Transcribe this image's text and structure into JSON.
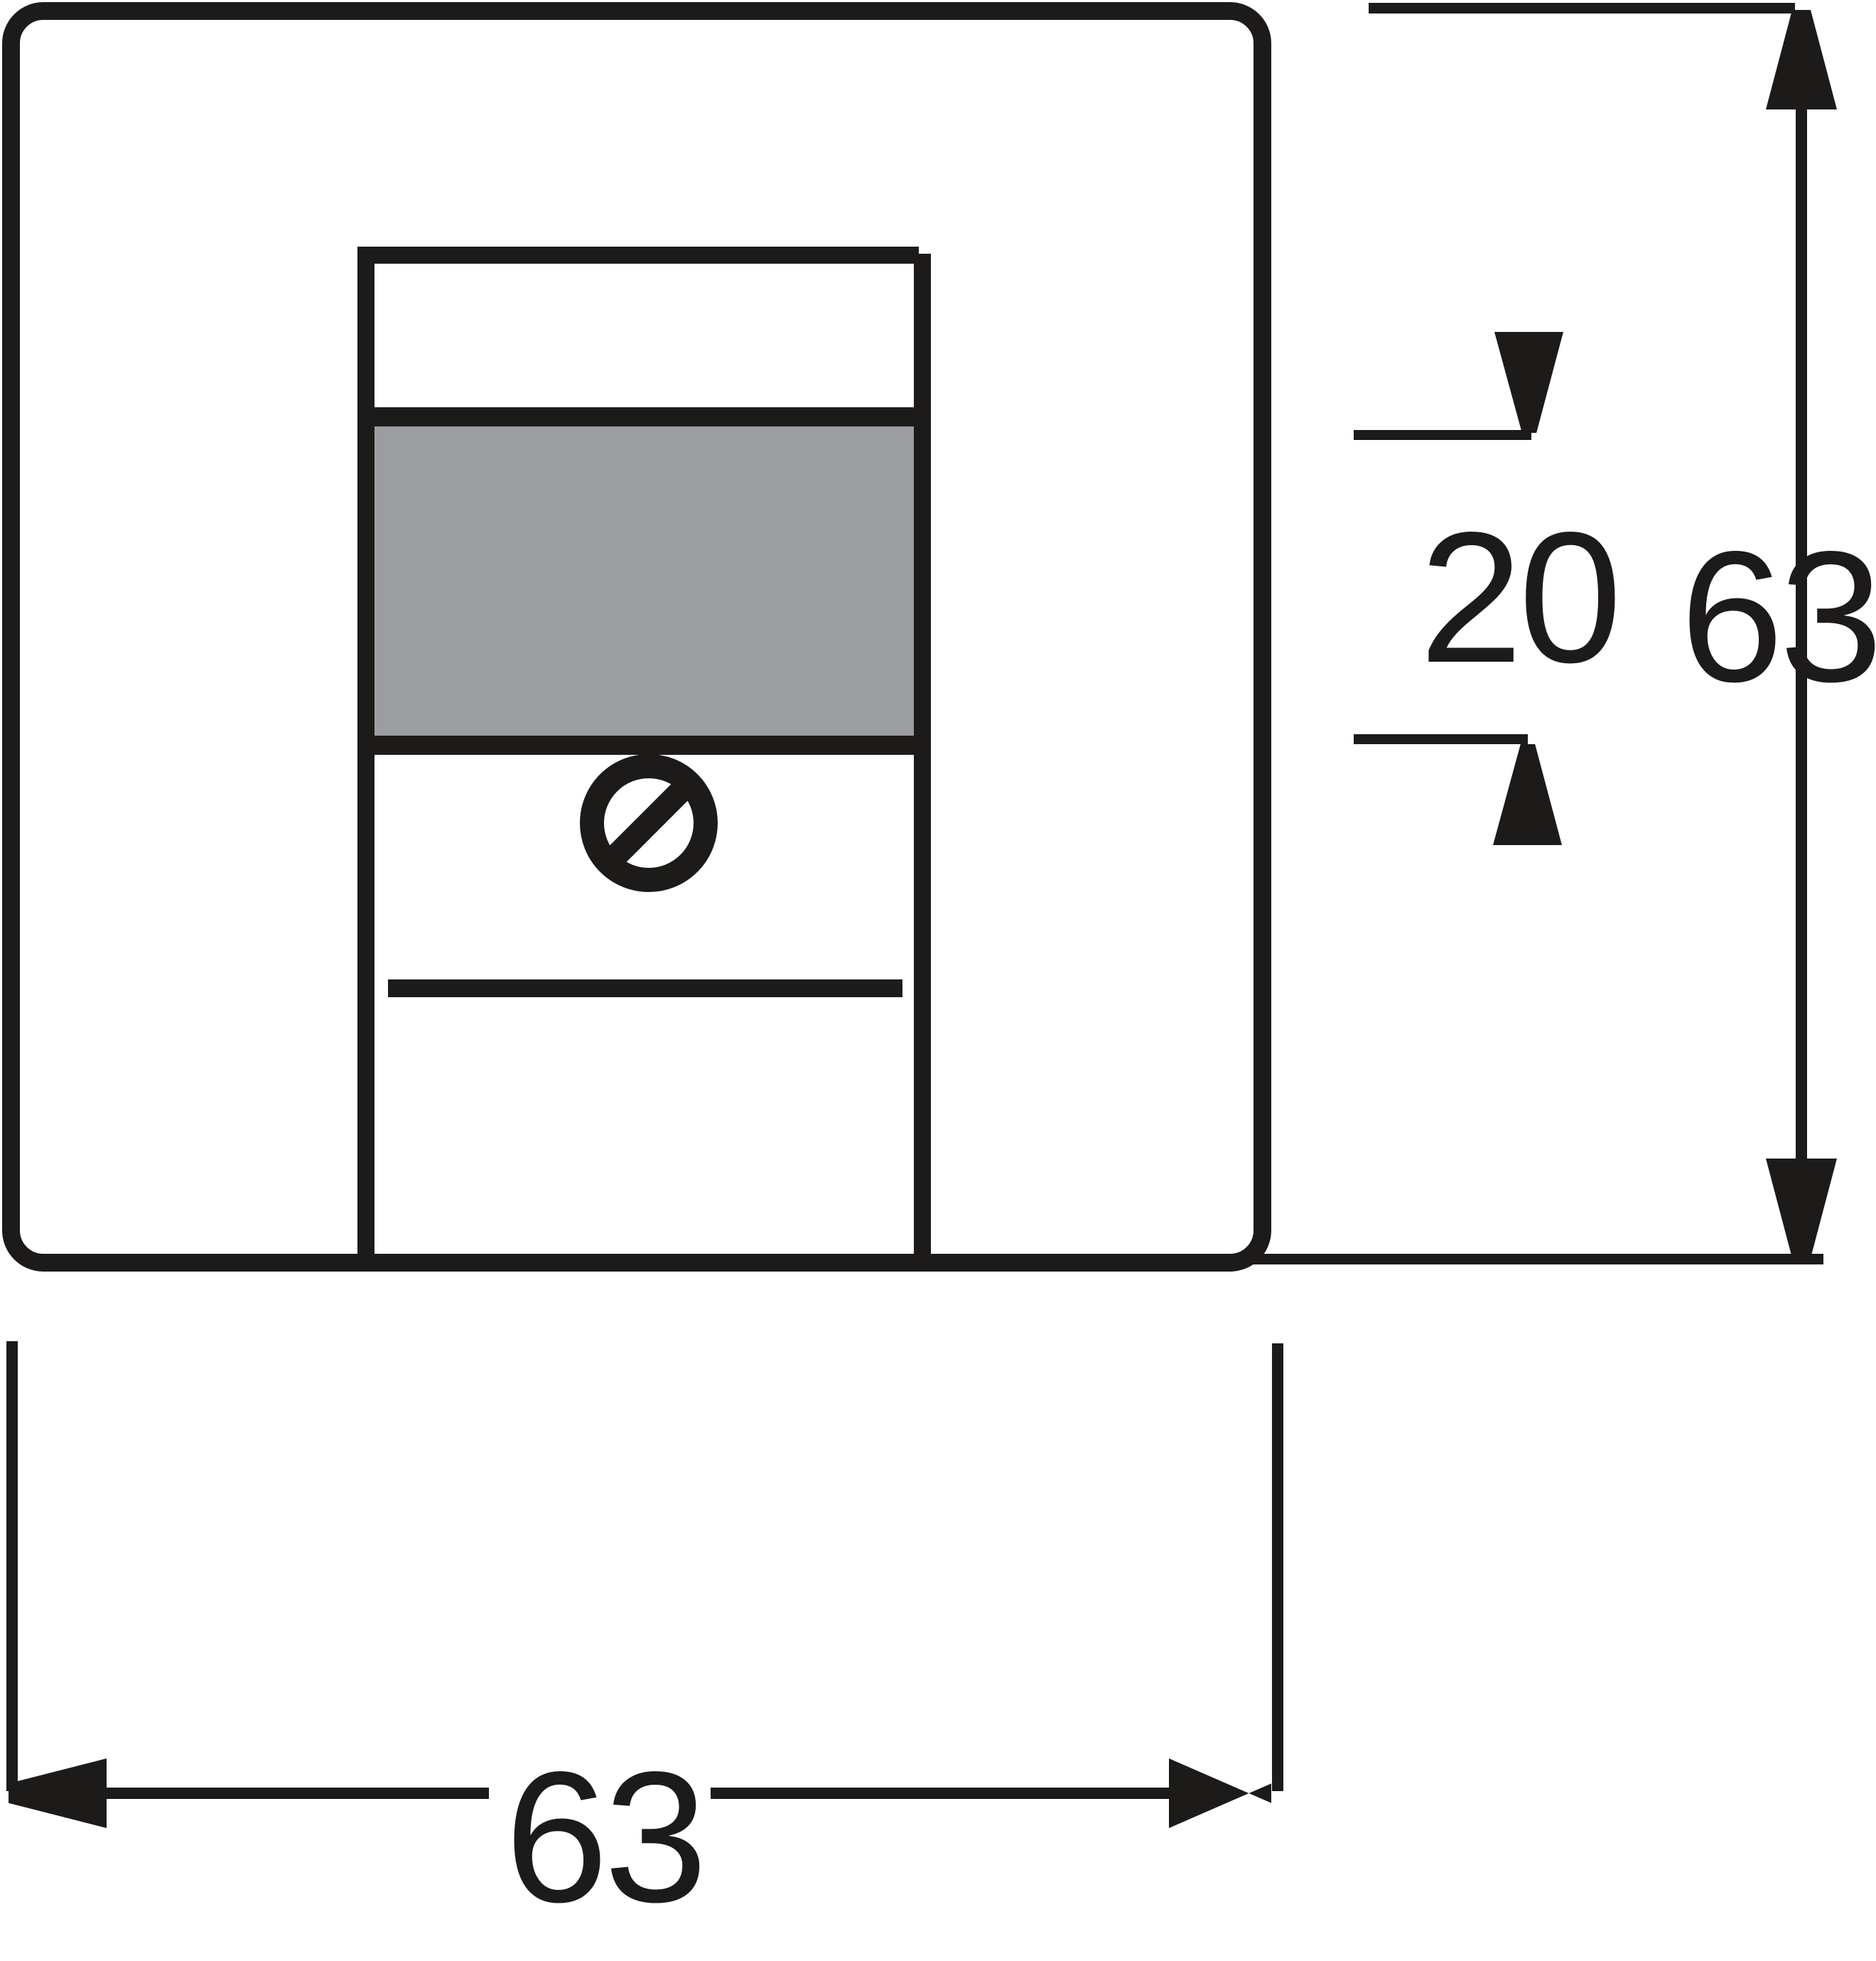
{
  "drawing": {
    "type": "dimensional-drawing",
    "subject": "square cover plate with socket insert, label field and fixing screw",
    "labels": {
      "field_height": "20",
      "plate_height": "63",
      "plate_width": "63"
    },
    "colors": {
      "ink": "#1d1b1a",
      "field_gray": "#9b9da0",
      "background": "#ffffff"
    },
    "icons": {
      "screw": "slotted-screw-icon"
    }
  }
}
